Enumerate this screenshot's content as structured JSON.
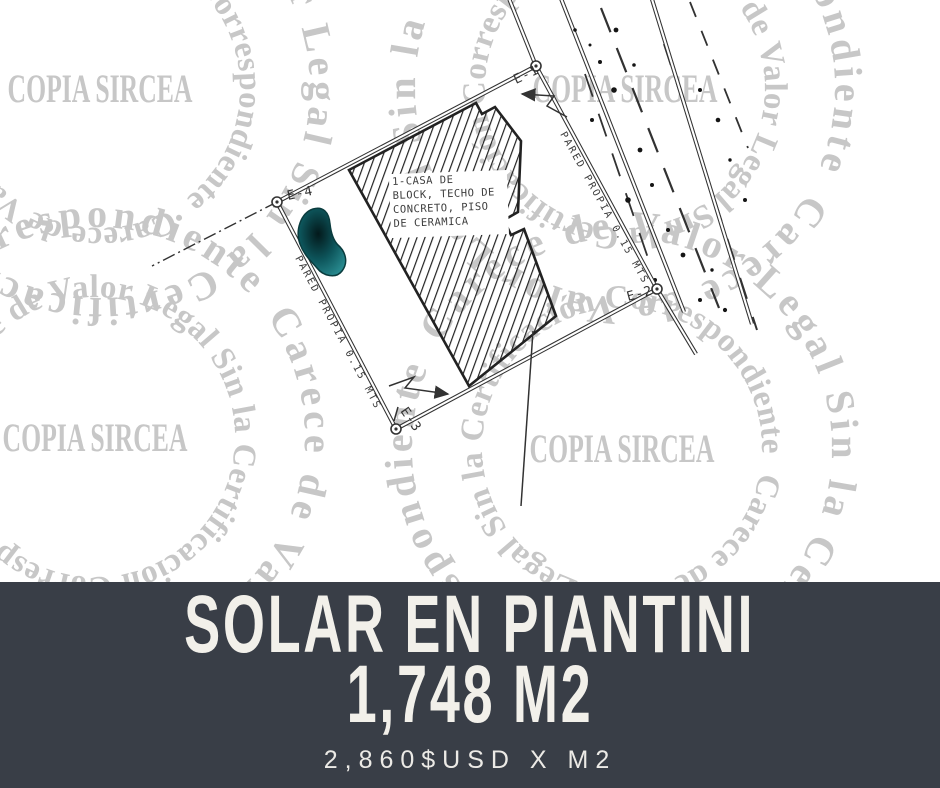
{
  "banner": {
    "title_line1": "SOLAR EN PIANTINI",
    "title_line2": "1,748 M2",
    "price": "2,860$USD X M2",
    "background": "#393e47",
    "text_color": "#f2f0ea"
  },
  "watermark": {
    "center_text": "COPIA SIRCEA",
    "ring_text": "Carece de Valor Legal Sin la Certificación Correspondiente",
    "color": "#c7c7c7"
  },
  "plan": {
    "ink_color": "#323232",
    "stamp_blob_color": "#116d73",
    "building_label": [
      "1-CASA DE",
      "BLOCK, TECHO DE",
      "CONCRETO, PISO",
      "DE CERAMICA"
    ],
    "wall_labels": {
      "left": "PARED PROPIA 0.15 MTS",
      "right": "PARED PROPIA 0.15 MTS"
    },
    "corners": [
      {
        "id": "E-1"
      },
      {
        "id": "E-2"
      },
      {
        "id": "E-3"
      },
      {
        "id": "E-4"
      }
    ]
  }
}
